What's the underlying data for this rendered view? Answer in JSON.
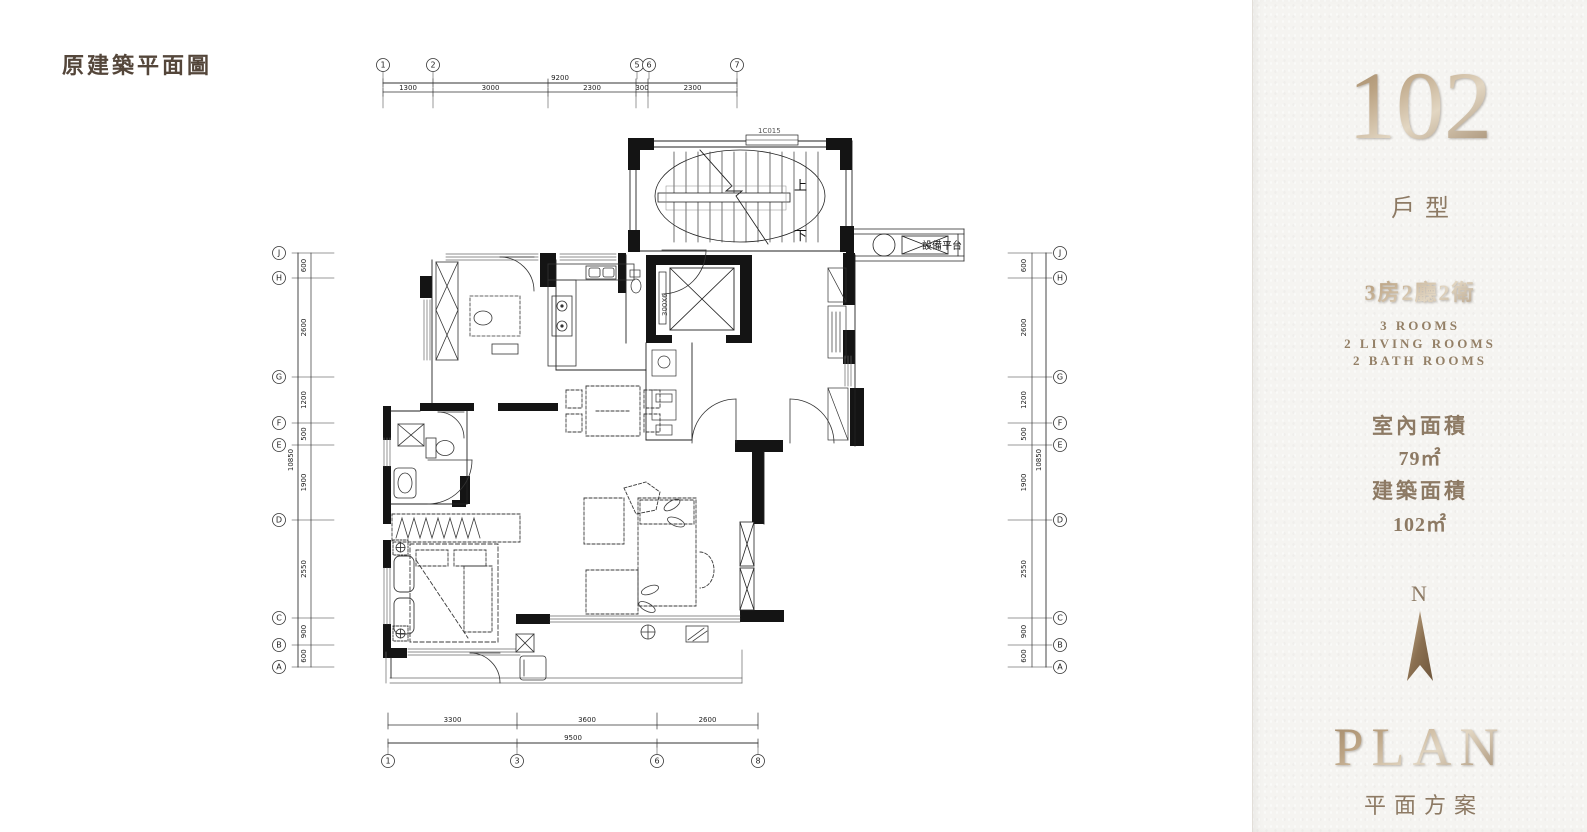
{
  "page": {
    "title": "原建築平面圖"
  },
  "sidebar": {
    "unit_number": "102",
    "unit_type_label": "戶型",
    "layout_cn": "3房2廳2衛",
    "layout_en_1": "3 ROOMS",
    "layout_en_2": "2 LIVING ROOMS",
    "layout_en_3": "2 BATH ROOMS",
    "interior_area_label": "室內面積",
    "interior_area_value": "79㎡",
    "construction_area_label": "建築面積",
    "construction_area_value": "102㎡",
    "north_label": "N",
    "plan_en": "PLAN",
    "plan_cn": "平面方案"
  },
  "colors": {
    "accent": "#8d7a64",
    "title_text": "#54463a",
    "line": "#1a1a1a"
  },
  "plan": {
    "annotations": {
      "up": "上",
      "down": "下",
      "equipment_platform": "設備平台",
      "window_tag": "1C015",
      "shaft_tag": "300X6"
    },
    "grid": {
      "top": {
        "overall": "9200",
        "segments": [
          "1300",
          "3000",
          "2300",
          "300",
          "2300"
        ],
        "bubbles": [
          "1",
          "2",
          "5",
          "6",
          "7"
        ]
      },
      "bottom": {
        "overall": "9500",
        "segments": [
          "3300",
          "3600",
          "2600"
        ],
        "bubbles": [
          "1",
          "3",
          "6",
          "8"
        ]
      },
      "left": {
        "overall": "10850",
        "segments": [
          "600",
          "2600",
          "1200",
          "500",
          "1900",
          "2550",
          "900",
          "600"
        ],
        "bubbles": [
          "J",
          "H",
          "G",
          "F",
          "E",
          "D",
          "C",
          "B",
          "A"
        ]
      },
      "right": {
        "overall": "10850",
        "segments": [
          "600",
          "2600",
          "1200",
          "500",
          "1900",
          "2550",
          "900",
          "600"
        ],
        "bubbles": [
          "J",
          "H",
          "G",
          "F",
          "E",
          "D",
          "C",
          "B",
          "A"
        ]
      }
    }
  }
}
